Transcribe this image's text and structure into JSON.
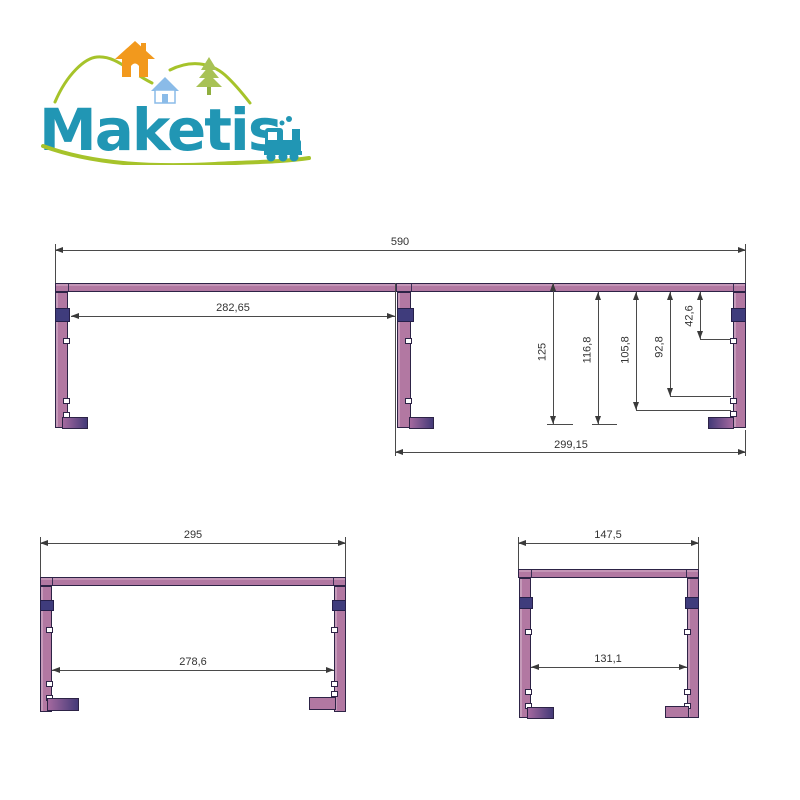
{
  "logo": {
    "brand": "Maketis",
    "colors": {
      "teal": "#2196b4",
      "green": "#a6c32a",
      "orange": "#f2991d",
      "light_blue": "#8abbe8",
      "pine_green": "#a8c255"
    }
  },
  "colors": {
    "wood_mauve": "#b278a2",
    "wood_indigo_band": "#3f3c7c",
    "foot_dark_purple": "#443a78",
    "dimension_line": "#4a4a4a",
    "background": "#ffffff"
  },
  "drawings": {
    "front_view": {
      "overall_width": "590",
      "left_bay_inner_width": "282,65",
      "right_bay_width": "299,15",
      "height_dimensions": [
        {
          "label": "125"
        },
        {
          "label": "116,8"
        },
        {
          "label": "105,8"
        },
        {
          "label": "92,8"
        },
        {
          "label": "42,6"
        }
      ]
    },
    "side_view_medium": {
      "overall_width": "295",
      "inner_width": "278,6"
    },
    "side_view_small": {
      "overall_width": "147,5",
      "inner_width": "131,1"
    }
  }
}
